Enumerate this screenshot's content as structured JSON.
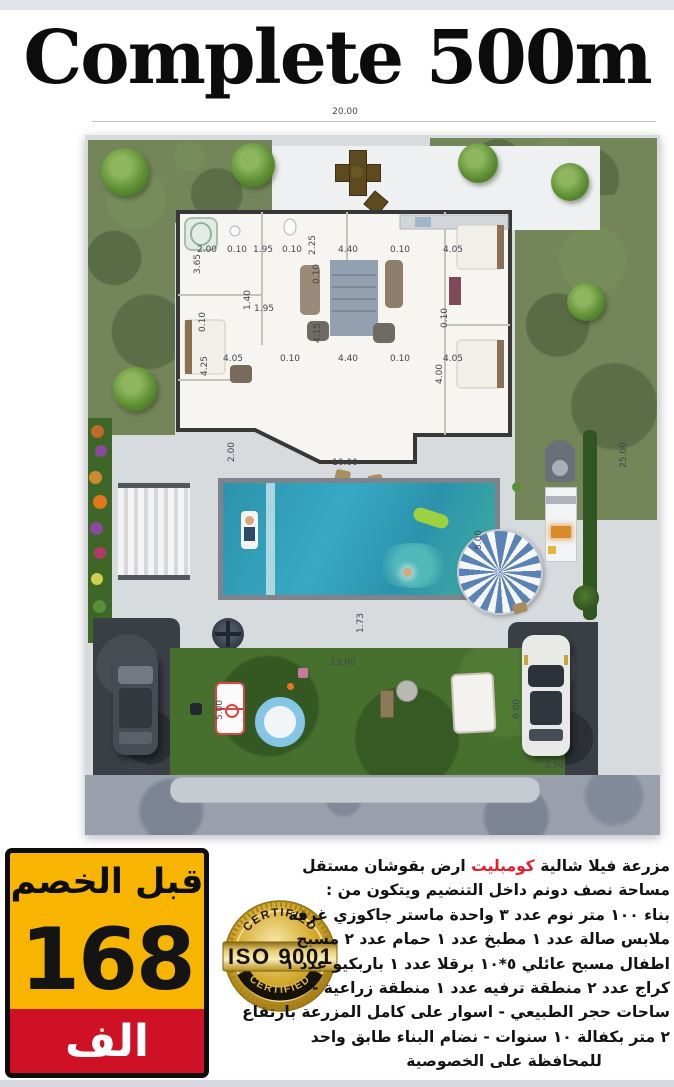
{
  "title": "Complete 500m",
  "plan": {
    "dimensions": [
      {
        "t": "20.00",
        "x": 345,
        "y": 112
      },
      {
        "t": "25.00",
        "x": 624,
        "y": 455,
        "v": true
      },
      {
        "t": "2.00",
        "x": 207,
        "y": 250
      },
      {
        "t": "0.10",
        "x": 237,
        "y": 250
      },
      {
        "t": "1.95",
        "x": 263,
        "y": 250
      },
      {
        "t": "0.10",
        "x": 292,
        "y": 250
      },
      {
        "t": "2.25",
        "x": 313,
        "y": 245,
        "v": true
      },
      {
        "t": "4.40",
        "x": 348,
        "y": 250
      },
      {
        "t": "0.10",
        "x": 400,
        "y": 250
      },
      {
        "t": "4.05",
        "x": 453,
        "y": 250
      },
      {
        "t": "3.65",
        "x": 198,
        "y": 264,
        "v": true
      },
      {
        "t": "0.10",
        "x": 317,
        "y": 274,
        "v": true
      },
      {
        "t": "1.40",
        "x": 248,
        "y": 300,
        "v": true
      },
      {
        "t": "1.95",
        "x": 264,
        "y": 309
      },
      {
        "t": "4.15",
        "x": 318,
        "y": 333,
        "v": true
      },
      {
        "t": "0.10",
        "x": 445,
        "y": 318,
        "v": true
      },
      {
        "t": "0.10",
        "x": 203,
        "y": 322,
        "v": true
      },
      {
        "t": "4.25",
        "x": 205,
        "y": 366,
        "v": true
      },
      {
        "t": "4.05",
        "x": 233,
        "y": 359
      },
      {
        "t": "0.10",
        "x": 290,
        "y": 359
      },
      {
        "t": "4.40",
        "x": 348,
        "y": 359
      },
      {
        "t": "0.10",
        "x": 400,
        "y": 359
      },
      {
        "t": "4.05",
        "x": 453,
        "y": 359
      },
      {
        "t": "4.00",
        "x": 440,
        "y": 374,
        "v": true
      },
      {
        "t": "2.00",
        "x": 232,
        "y": 452,
        "v": true
      },
      {
        "t": "10.00",
        "x": 345,
        "y": 463
      },
      {
        "t": "5.00",
        "x": 479,
        "y": 540,
        "v": true
      },
      {
        "t": "1.73",
        "x": 361,
        "y": 623,
        "v": true
      },
      {
        "t": "13.00",
        "x": 343,
        "y": 663
      },
      {
        "t": "5.00",
        "x": 220,
        "y": 710,
        "v": true
      },
      {
        "t": "3.50",
        "x": 137,
        "y": 767
      },
      {
        "t": "6.00",
        "x": 517,
        "y": 709,
        "v": true
      },
      {
        "t": "3.50",
        "x": 554,
        "y": 766
      }
    ]
  },
  "price_box": {
    "header": "قبل الخصم",
    "amount": "168",
    "unit": "الف"
  },
  "badge": {
    "top_text": "CERTIFIED",
    "center_text": "ISO 9001",
    "bottom_text": "CERTIFIED"
  },
  "ad": {
    "lines": [
      [
        {
          "t": "مزرعة فيلا شالية "
        },
        {
          "t": "كومبليت",
          "red": true
        },
        {
          "t": "  ارض بقوشان مستقل"
        }
      ],
      [
        {
          "t": "مساحة نصف دونم  داخل التنضيم ويتكون من :"
        }
      ],
      [
        {
          "t": "بناء ١٠٠ متر نوم عدد ٣ واحدة ماستر جاكوزي غرفة"
        }
      ],
      [
        {
          "t": "ملابس  صالة عدد ١ مطبخ عدد ١ حمام  عدد ٢ مسبح"
        }
      ],
      [
        {
          "t": "اطفال مسبح عائلي ٥*١٠ برقلا عدد ١ باربكيو عدد ١"
        }
      ],
      [
        {
          "t": "كراج عدد ٢ منطقة ترفيه عدد ١ منطقة زراعية  -"
        }
      ],
      [
        {
          "t": "ساحات حجر الطبيعي - اسوار على كامل المزرعة بارتفاع"
        }
      ],
      [
        {
          "t": "٢ متر بكفالة ١٠ سنوات - نضام البناء طابق واحد"
        }
      ],
      [
        {
          "t": "للمحافظة على الخصوصية"
        }
      ]
    ]
  },
  "colors": {
    "price_yellow": "#f7b500",
    "price_red": "#cf1126",
    "accent_red": "#e8192c",
    "badge_gold": "#d4aa2e"
  }
}
